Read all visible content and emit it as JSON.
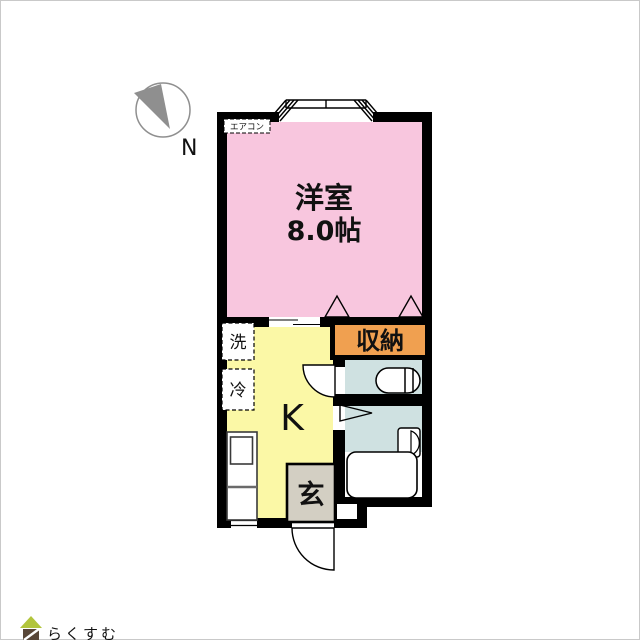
{
  "compass": {
    "north_label": "N"
  },
  "rooms": {
    "western": {
      "name": "洋室",
      "size": "8.0帖"
    },
    "kitchen": {
      "label": "K"
    },
    "closet": {
      "label": "収納"
    },
    "entrance": {
      "label": "玄"
    },
    "washer": {
      "label": "洗"
    },
    "fridge": {
      "label": "冷"
    },
    "aircon": {
      "label": "エアコン"
    }
  },
  "colors": {
    "western_room": "#f8c6de",
    "kitchen": "#fbf8a6",
    "closet": "#f0a050",
    "bath": "#cfe1e1",
    "entrance": "#d3cfc3",
    "wall": "#000000",
    "fixture": "#ffffff",
    "compass_gray": "#8f8f8f",
    "compass_letter": "#9b9b9b"
  },
  "footer": {
    "brand": "らくすむ",
    "roof_color": "#b2c53c",
    "body_color": "#594738",
    "text_color": "#8c7e71"
  }
}
